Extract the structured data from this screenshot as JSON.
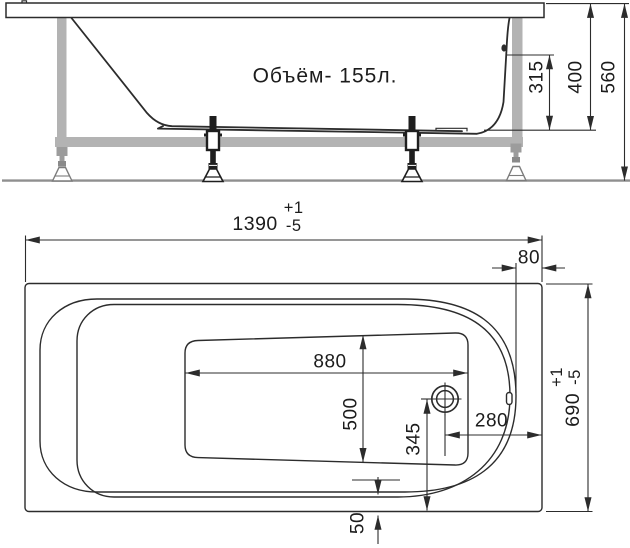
{
  "side_view": {
    "volume_label": "Объём- 155л.",
    "dims": {
      "overflow_height": "315",
      "tub_height": "400",
      "total_height": "560"
    }
  },
  "plan_view": {
    "dims": {
      "length": "1390",
      "length_tol_plus": "+1",
      "length_tol_minus": "-5",
      "rim_offset_right": "80",
      "bottom_length": "880",
      "bottom_width": "500",
      "drain_offset_long": "345",
      "drain_offset_short": "280",
      "apron_gap": "50",
      "width": "690",
      "width_tol_plus": "+1",
      "width_tol_minus": "-5"
    }
  },
  "colors": {
    "line": "#2c2c2c",
    "frame_gray": "#b3b3b3",
    "floor_gray": "#8f8f8f",
    "background": "#ffffff"
  }
}
